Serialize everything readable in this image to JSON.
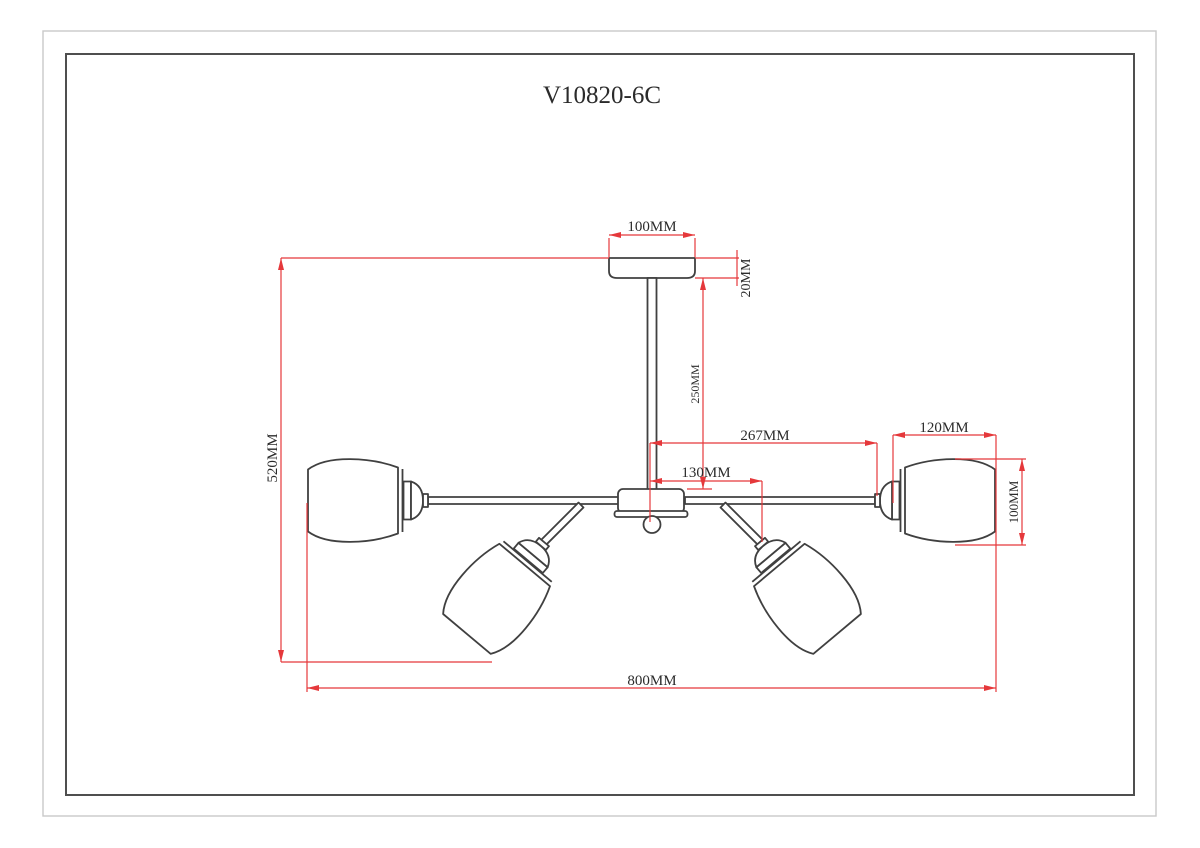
{
  "title": "V10820-6C",
  "dimensions": {
    "canopy_diameter": "100MM",
    "canopy_height": "20MM",
    "rod_length": "250MM",
    "arm_reach_outer": "267MM",
    "arm_reach_inner": "130MM",
    "overall_height": "520MM",
    "overall_width": "800MM",
    "shade_width": "120MM",
    "shade_height": "100MM"
  },
  "colors": {
    "drawing_line": "#404040",
    "dimension_line": "#e5383b",
    "border_outer": "#c9c9c9",
    "border_inner": "#4f4f4f"
  }
}
